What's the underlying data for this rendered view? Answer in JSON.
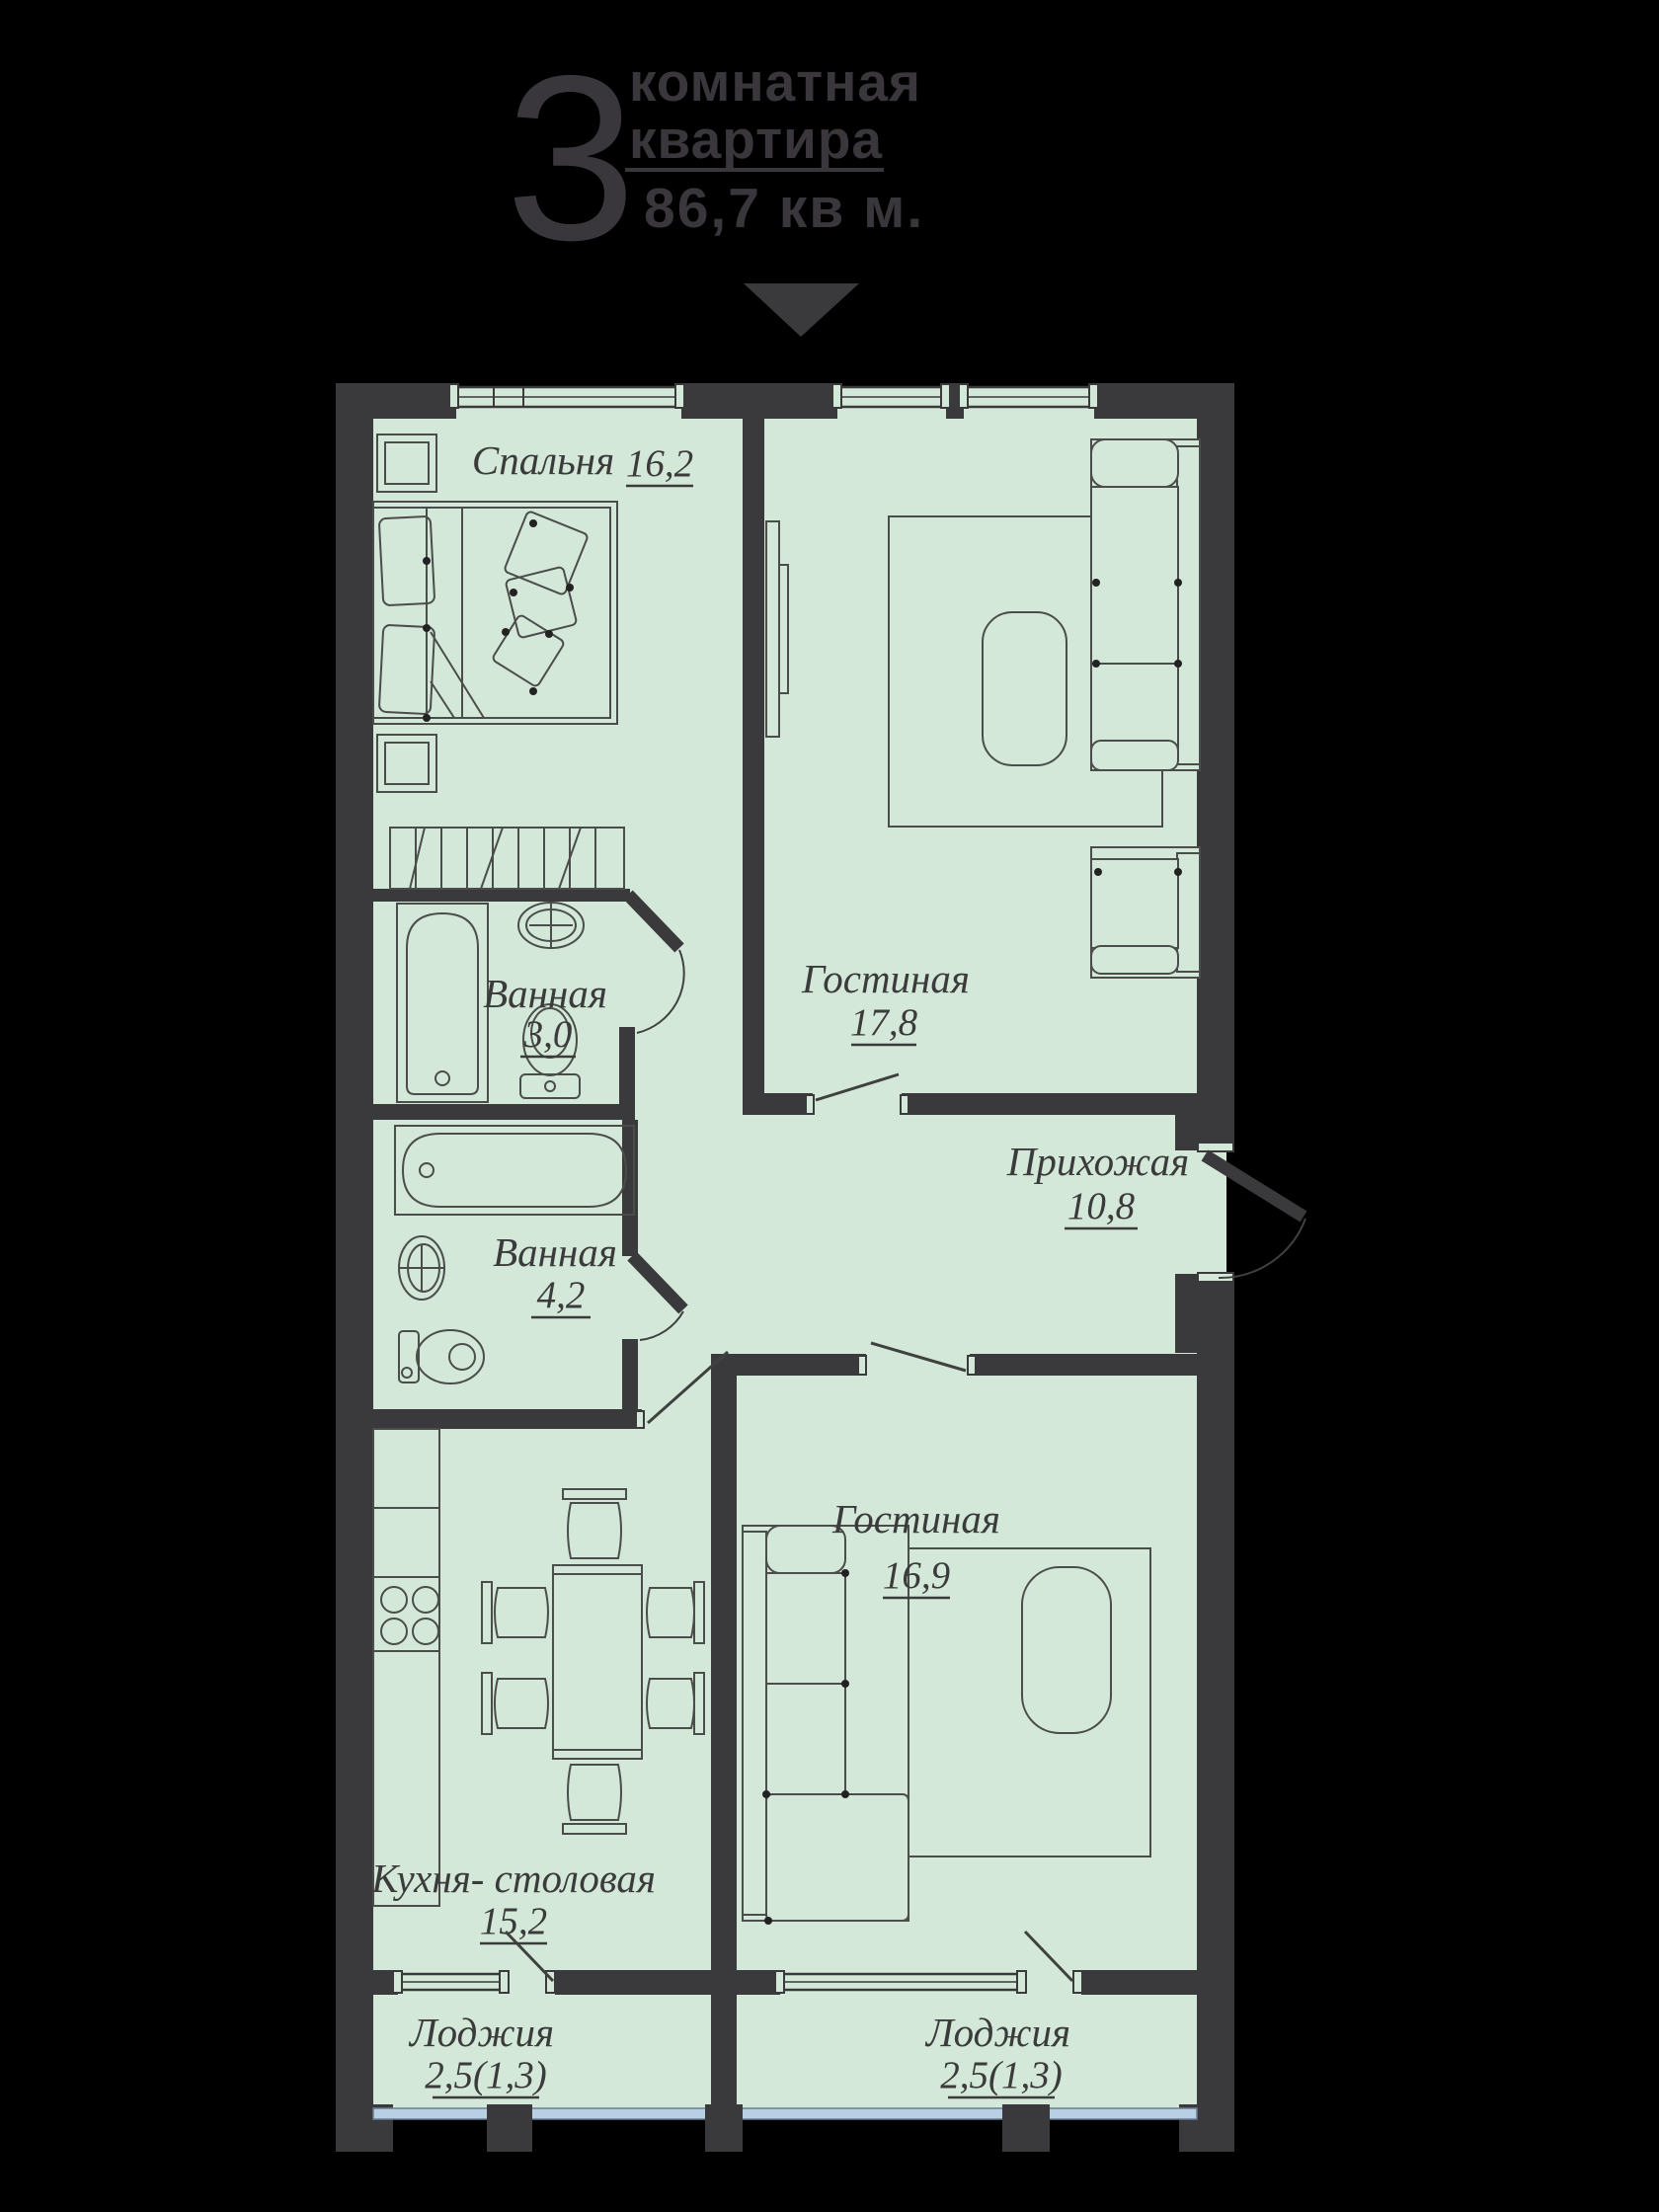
{
  "header": {
    "rooms_count": "3",
    "title_line1": "комнатная",
    "title_line2": "квартира",
    "total_area": "86,7 кв м."
  },
  "rooms": {
    "bedroom": {
      "name": "Спальня",
      "area": "16,2"
    },
    "living1": {
      "name": "Гостиная",
      "area": "17,8"
    },
    "bath_small": {
      "name": "Ванная",
      "area": "3,0"
    },
    "bath_big": {
      "name": "Ванная",
      "area": "4,2"
    },
    "hallway": {
      "name": "Прихожая",
      "area": "10,8"
    },
    "living2": {
      "name": "Гостиная",
      "area": "16,9"
    },
    "kitchen": {
      "name": "Кухня- столовая",
      "area": "15,2"
    },
    "loggia_left": {
      "name": "Лоджия",
      "area": "2,5(1,3)"
    },
    "loggia_right": {
      "name": "Лоджия",
      "area": "2,5(1,3)"
    }
  },
  "colors": {
    "background": "#000000",
    "wall": "#3a393b",
    "floor": "#d3e8d8",
    "furniture_line": "#4a4d4a",
    "label_text": "#3b3b3b",
    "header_text": "#39373b",
    "loggia_glazing": "#b8cfe4"
  }
}
